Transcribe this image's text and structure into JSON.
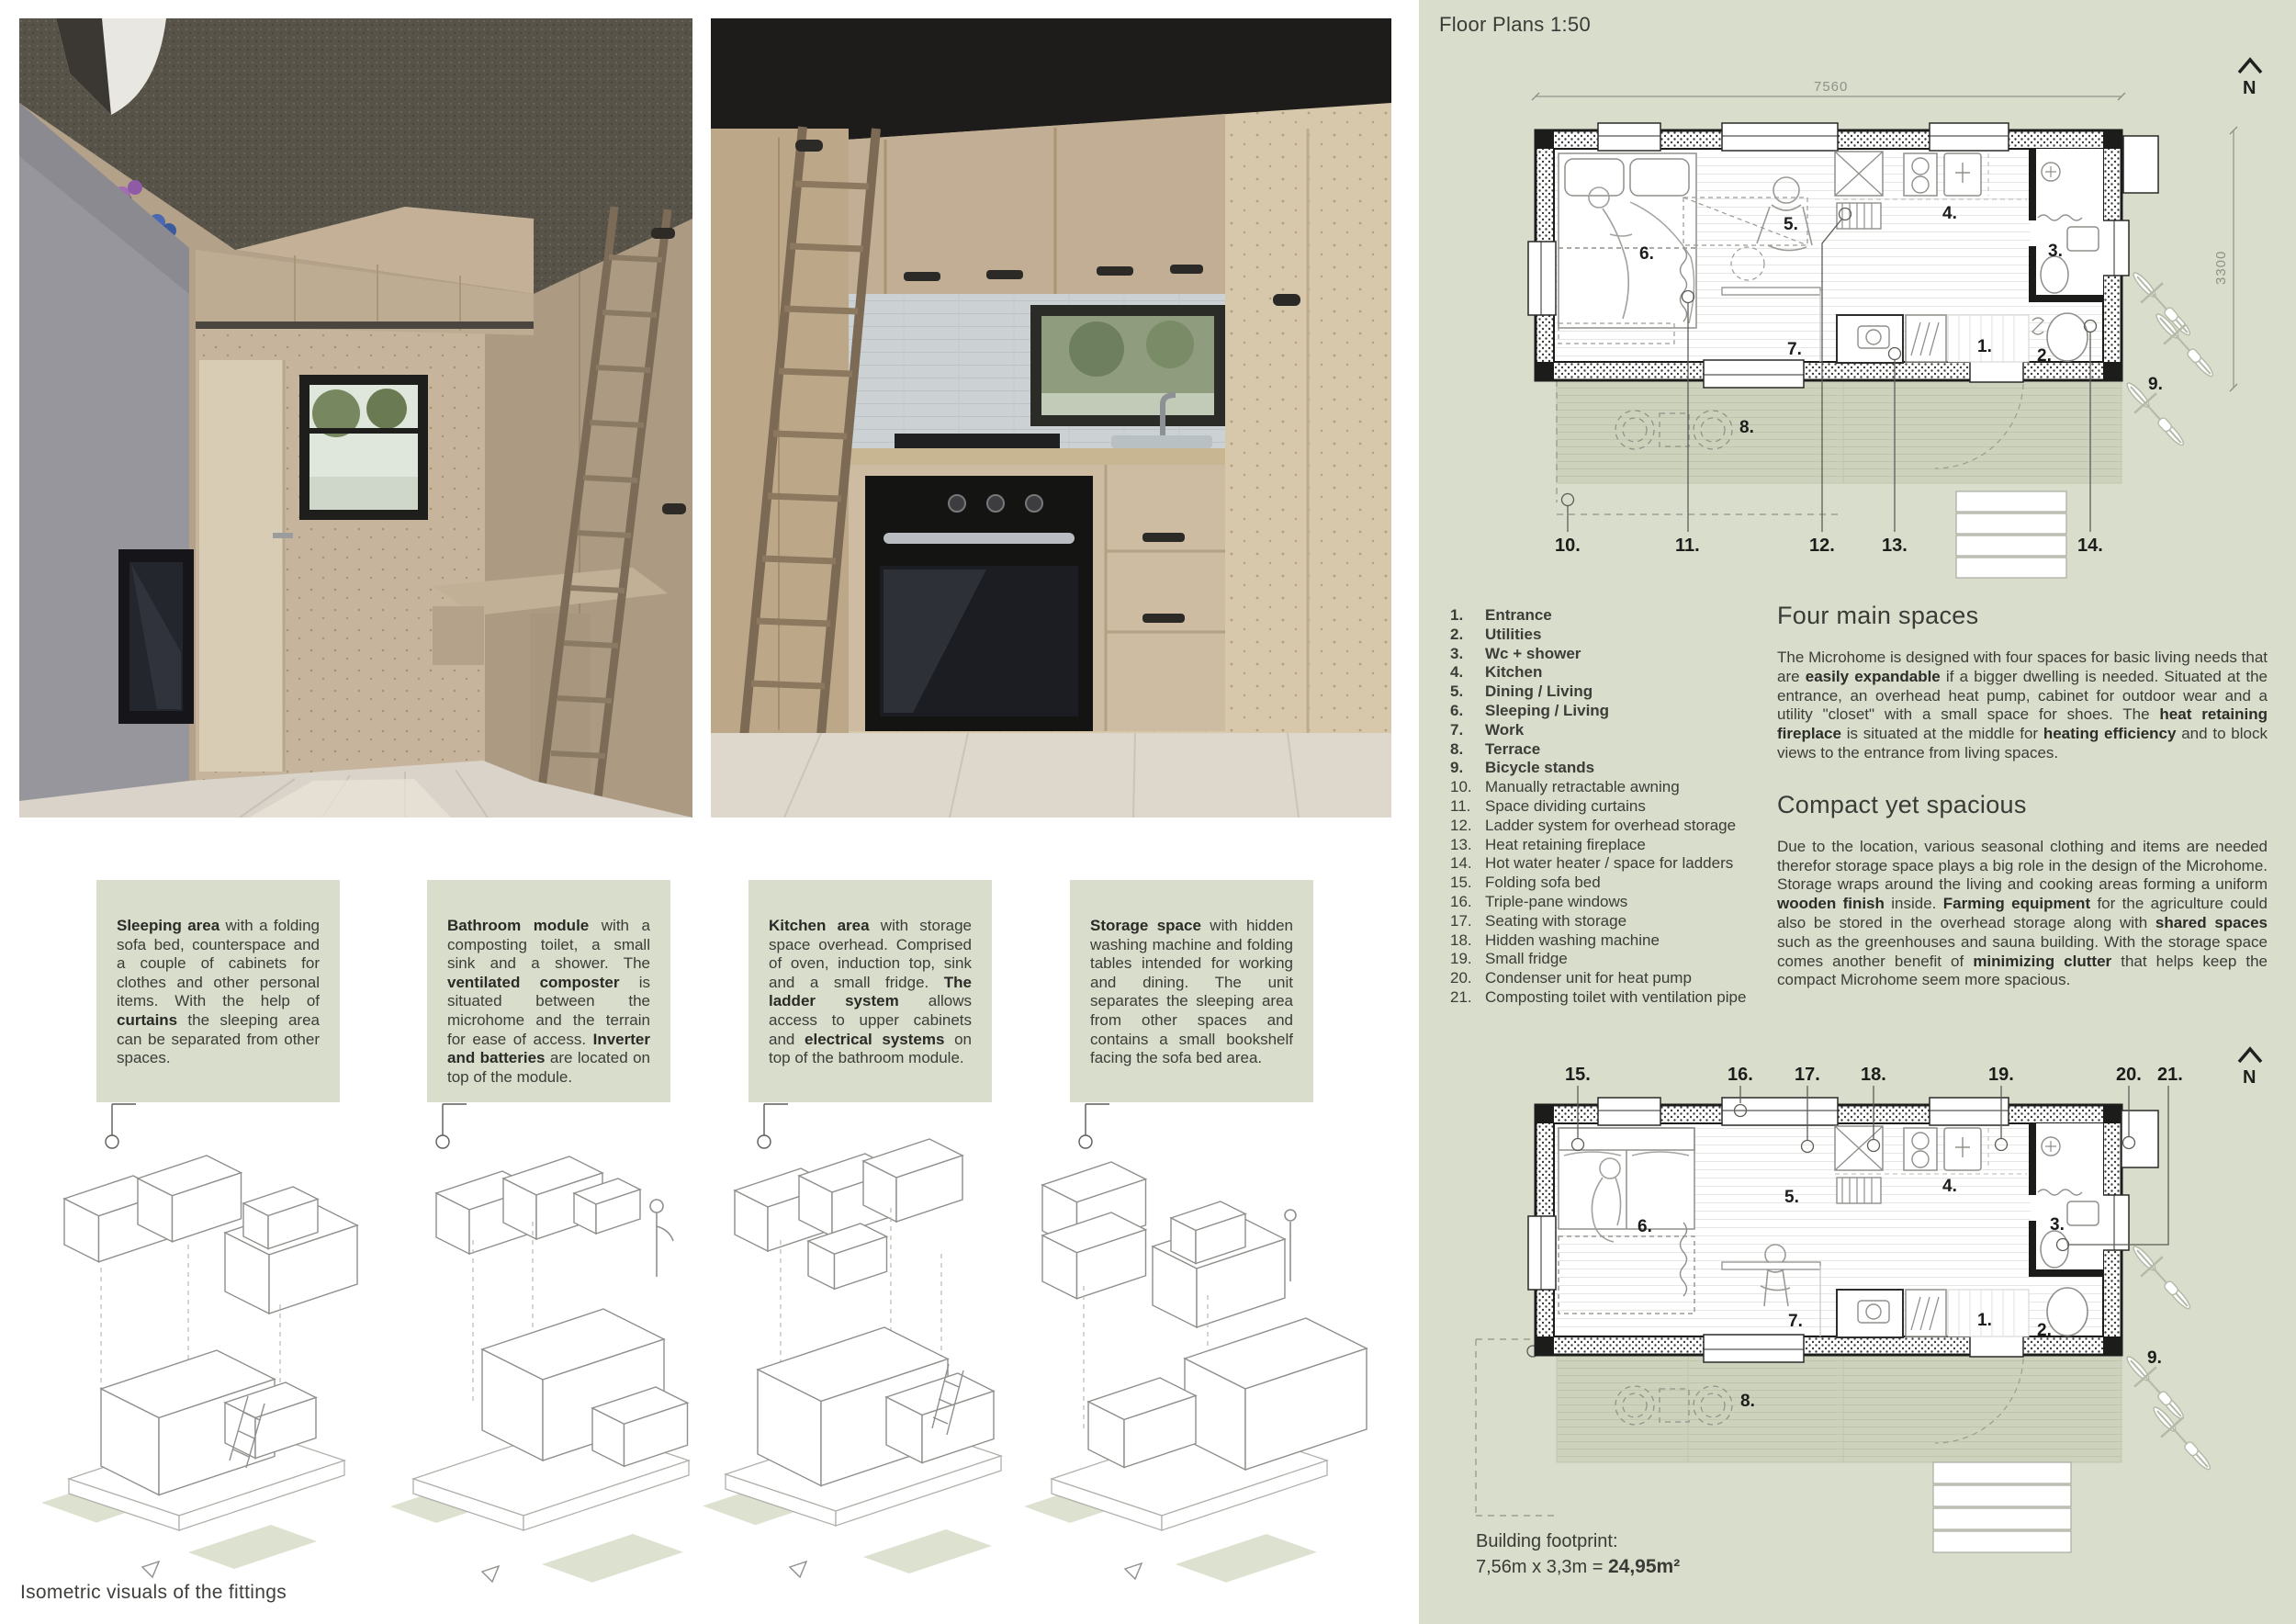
{
  "left": {
    "boxes": [
      {
        "segments": [
          {
            "t": "Sleeping area",
            "b": true
          },
          {
            "t": " with a folding sofa bed, counterspace and a couple of cabinets for clothes and other personal items. With the help of "
          },
          {
            "t": "curtains",
            "b": true
          },
          {
            "t": " the sleeping area can be separated from other spaces."
          }
        ]
      },
      {
        "segments": [
          {
            "t": "Bathroom module",
            "b": true
          },
          {
            "t": " with a composting toilet, a small sink and a shower. The "
          },
          {
            "t": "ventilated composter",
            "b": true
          },
          {
            "t": " is situated between the microhome and the terrain for ease of access. "
          },
          {
            "t": "Inverter and batteries",
            "b": true
          },
          {
            "t": " are located on top of the module."
          }
        ]
      },
      {
        "segments": [
          {
            "t": "Kitchen area",
            "b": true
          },
          {
            "t": " with storage space overhead. Comprised of oven, induction top, sink and a small fridge. "
          },
          {
            "t": "The ladder system",
            "b": true
          },
          {
            "t": " allows access to upper cabinets and "
          },
          {
            "t": "electrical systems",
            "b": true
          },
          {
            "t": " on top of the bathroom module."
          }
        ]
      },
      {
        "segments": [
          {
            "t": "Storage space",
            "b": true
          },
          {
            "t": " with hidden washing machine and folding tables intended for working and dining. The unit separates the sleeping area from other spaces and contains a small bookshelf facing the sofa bed area."
          }
        ]
      }
    ],
    "caption": "Isometric visuals of the fittings"
  },
  "panel": {
    "title": "Floor Plans 1:50",
    "bg": "#d9ddcb",
    "legend": [
      {
        "num": "1.",
        "label": "Entrance"
      },
      {
        "num": "2.",
        "label": "Utilities"
      },
      {
        "num": "3.",
        "label": "Wc + shower"
      },
      {
        "num": "4.",
        "label": "Kitchen"
      },
      {
        "num": "5.",
        "label": "Dining / Living"
      },
      {
        "num": "6.",
        "label": "Sleeping / Living"
      },
      {
        "num": "7.",
        "label": "Work"
      },
      {
        "num": "8.",
        "label": "Terrace"
      },
      {
        "num": "9.",
        "label": "Bicycle stands"
      },
      {
        "num": "10.",
        "label": "Manually retractable awning"
      },
      {
        "num": "11.",
        "label": "Space dividing curtains"
      },
      {
        "num": "12.",
        "label": "Ladder system for overhead storage"
      },
      {
        "num": "13.",
        "label": "Heat retaining fireplace"
      },
      {
        "num": "14.",
        "label": "Hot water heater / space for ladders"
      },
      {
        "num": "15.",
        "label": "Folding sofa bed"
      },
      {
        "num": "16.",
        "label": "Triple-pane windows"
      },
      {
        "num": "17.",
        "label": "Seating with storage"
      },
      {
        "num": "18.",
        "label": "Hidden washing machine"
      },
      {
        "num": "19.",
        "label": "Small fridge"
      },
      {
        "num": "20.",
        "label": "Condenser unit for heat pump"
      },
      {
        "num": "21.",
        "label": "Composting toilet with ventilation pipe"
      }
    ],
    "sections": [
      {
        "heading": "Four main spaces",
        "segments": [
          {
            "t": "The Microhome is designed with four spaces for basic living needs that are "
          },
          {
            "t": "easily expandable",
            "b": true
          },
          {
            "t": " if a bigger dwelling is needed. Situated at the entrance, an overhead heat pump, cabinet for outdoor wear and a utility \"closet\" with a small space for shoes. The "
          },
          {
            "t": "heat retaining fireplace",
            "b": true
          },
          {
            "t": " is situated at the middle for "
          },
          {
            "t": "heating efficiency",
            "b": true
          },
          {
            "t": " and to block views to the entrance from living spaces."
          }
        ]
      },
      {
        "heading": "Compact yet spacious",
        "segments": [
          {
            "t": "Due to the location, various seasonal clothing and items are needed therefor storage space plays a big role in the design of the Microhome. Storage wraps around the living and cooking areas forming a uniform "
          },
          {
            "t": "wooden finish",
            "b": true
          },
          {
            "t": " inside. "
          },
          {
            "t": "Farming equipment",
            "b": true
          },
          {
            "t": " for the agriculture could also be stored in the overhead storage along with "
          },
          {
            "t": "shared spaces",
            "b": true
          },
          {
            "t": " such as the greenhouses and sauna building. With the storage space comes another benefit of "
          },
          {
            "t": "minimizing clutter",
            "b": true
          },
          {
            "t": " that helps keep the compact Microhome seem more spacious."
          }
        ]
      }
    ],
    "plan_a": {
      "dim_top": "7560",
      "dim_right": "3300",
      "north": "N",
      "rooms": [
        "1.",
        "2.",
        "3.",
        "4.",
        "5.",
        "6.",
        "7.",
        "8.",
        "9."
      ],
      "callouts": [
        "10.",
        "11.",
        "12.",
        "13.",
        "14."
      ]
    },
    "plan_b": {
      "north": "N",
      "rooms": [
        "1.",
        "2.",
        "3.",
        "4.",
        "5.",
        "6.",
        "7.",
        "8.",
        "9."
      ],
      "callouts": [
        "15.",
        "16.",
        "17.",
        "18.",
        "19.",
        "20.",
        "21."
      ]
    },
    "footprint": {
      "label": "Building footprint:",
      "calc": "7,56m x 3,3m = ",
      "total": "24,95m²"
    }
  }
}
